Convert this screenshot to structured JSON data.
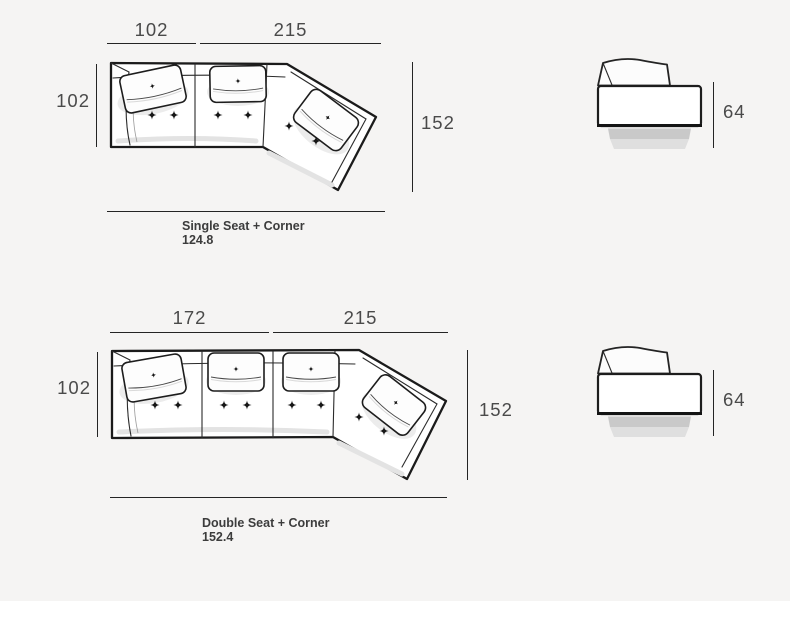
{
  "colors": {
    "background": "#f5f4f3",
    "line": "#242424",
    "dimension_text": "#4a4a4a",
    "caption_text": "#3c3c3c"
  },
  "diagrams": [
    {
      "name": "single-seat-corner",
      "top_dims": [
        "102",
        "215"
      ],
      "depth_dim": "102",
      "total_depth_dim": "152",
      "side_height_dim": "64",
      "caption_title": "Single Seat + Corner",
      "caption_value": "124.8"
    },
    {
      "name": "double-seat-corner",
      "top_dims": [
        "172",
        "215"
      ],
      "depth_dim": "102",
      "total_depth_dim": "152",
      "side_height_dim": "64",
      "caption_title": "Double Seat + Corner",
      "caption_value": "152.4"
    }
  ]
}
